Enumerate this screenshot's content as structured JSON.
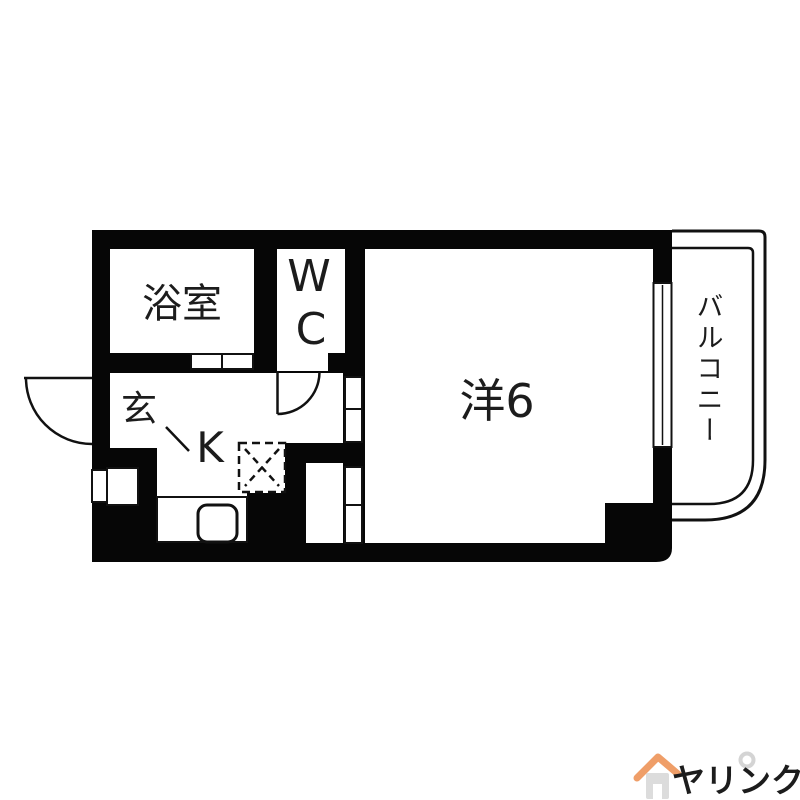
{
  "floor_plan": {
    "wall_color": "#000000",
    "floor_color": "#ffffff",
    "rooms": {
      "bathroom": {
        "label": "浴室"
      },
      "toilet": {
        "label_top": "W",
        "label_bottom": "C"
      },
      "western_room": {
        "label": "洋6"
      },
      "balcony": {
        "label": "バルコニー"
      },
      "entrance": {
        "label": "玄"
      },
      "kitchen": {
        "label": "K"
      }
    },
    "fixtures": {
      "kitchen_sink": "sink-icon",
      "appliance_space": "dashed-placement-box-icon",
      "shoe_cabinet": "cabinet-icon",
      "window": "sliding-window-icon",
      "doors": "swing-door-arc-icon"
    }
  },
  "branding": {
    "logo_text": "ヤリンク",
    "logo_color": "#ef9e68",
    "house_color": "#dcdcdc"
  }
}
